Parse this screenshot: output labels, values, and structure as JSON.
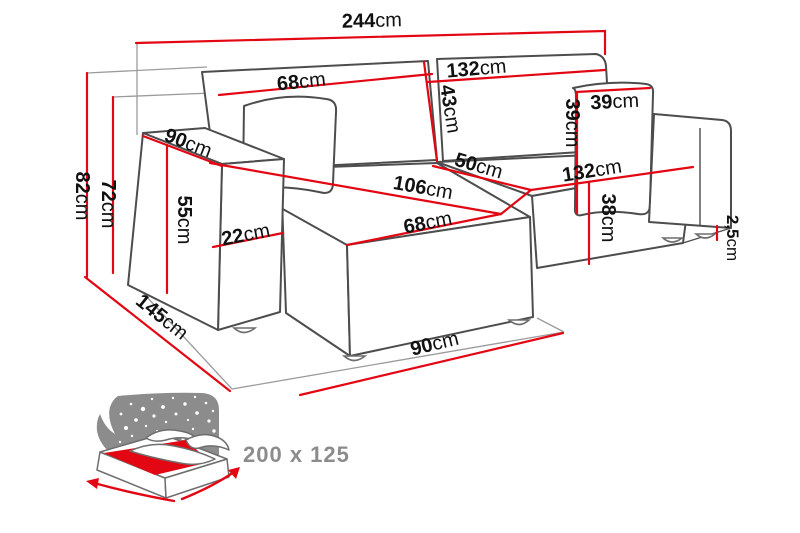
{
  "diagram": {
    "title": "corner-sofa-dimension-diagram",
    "colors": {
      "dimension_line": "#e30613",
      "sofa_outline": "#4d4d4d",
      "reference_line": "#9b9b9b",
      "label_text": "#111111",
      "icon_gray": "#8c8c8c",
      "background": "#ffffff"
    },
    "dimensions": {
      "sofa_total_width": {
        "value": "244",
        "unit": "cm"
      },
      "chaise_back_cushion_width": {
        "value": "68",
        "unit": "cm"
      },
      "right_back_cushion_width": {
        "value": "132",
        "unit": "cm"
      },
      "back_cushion_height": {
        "value": "43",
        "unit": "cm"
      },
      "pillow_width": {
        "value": "39",
        "unit": "cm"
      },
      "pillow_height": {
        "value": "39",
        "unit": "cm"
      },
      "armrest_top_length": {
        "value": "90",
        "unit": "cm"
      },
      "right_seat_depth": {
        "value": "50",
        "unit": "cm"
      },
      "chaise_seat_length": {
        "value": "106",
        "unit": "cm"
      },
      "right_seat_width": {
        "value": "132",
        "unit": "cm"
      },
      "total_height": {
        "value": "82",
        "unit": "cm"
      },
      "backrest_height": {
        "value": "72",
        "unit": "cm"
      },
      "armrest_height": {
        "value": "55",
        "unit": "cm"
      },
      "armrest_width": {
        "value": "22",
        "unit": "cm"
      },
      "chaise_seat_width": {
        "value": "68",
        "unit": "cm"
      },
      "seat_front_height": {
        "value": "38",
        "unit": "cm"
      },
      "leg_height": {
        "value": "2,5",
        "unit": "cm"
      },
      "chaise_total_depth": {
        "value": "145",
        "unit": "cm"
      },
      "base_front_depth": {
        "value": "90",
        "unit": "cm"
      }
    },
    "sleeping_area": {
      "label": "200 x 125"
    }
  }
}
